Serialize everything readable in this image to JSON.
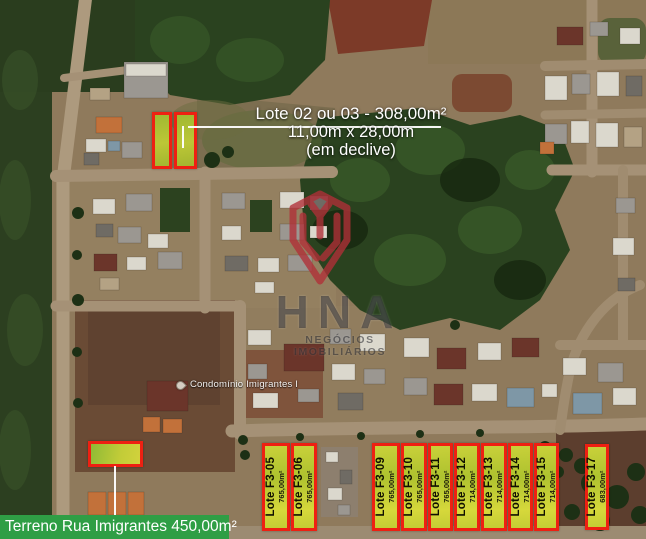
{
  "image": {
    "width": 646,
    "height": 539,
    "kind": "satellite-real-estate-listing"
  },
  "top_annotation": {
    "line1": "Lote 02 ou 03 - 308,00m²",
    "line2": "11,00m x 28,00m",
    "line3": "(em declive)"
  },
  "bottom_banner": {
    "text": "Terreno Rua Imigrantes 450,00m²"
  },
  "map_label": {
    "text": "Condomínio Imigrantes I"
  },
  "watermark": {
    "title": "HNA",
    "subtitle": "NEGÓCIOS IMOBILIÁRIOS"
  },
  "colors": {
    "lot_fill_yellow": "#c9d13a",
    "lot_border_red": "#ee2012",
    "banner_green": "#2f9e45",
    "annotation_text": "#ffffff",
    "watermark_red": "#b13038"
  },
  "top_lots": [
    {
      "id": "lote-02",
      "x": 152,
      "y": 112,
      "w": 20,
      "h": 57
    },
    {
      "id": "lote-03",
      "x": 174,
      "y": 112,
      "w": 23,
      "h": 57
    }
  ],
  "terreno_lot": {
    "id": "terreno-rua-imigrantes",
    "x": 88,
    "y": 441,
    "w": 55,
    "h": 26
  },
  "bottom_lots": [
    {
      "name": "Lote F3-05",
      "area": "765,00m²",
      "x": 262,
      "y": 443,
      "w": 28,
      "h": 88
    },
    {
      "name": "Lote F3-06",
      "area": "765,00m²",
      "x": 291,
      "y": 443,
      "w": 26,
      "h": 88
    },
    {
      "name": "Lote F3-09",
      "area": "765,00m²",
      "x": 372,
      "y": 443,
      "w": 28,
      "h": 88
    },
    {
      "name": "Lote F3-10",
      "area": "765,00m²",
      "x": 401,
      "y": 443,
      "w": 26,
      "h": 88
    },
    {
      "name": "Lote F3-11",
      "area": "765,00m²",
      "x": 428,
      "y": 443,
      "w": 25,
      "h": 88
    },
    {
      "name": "Lote F3-12",
      "area": "714,00m²",
      "x": 454,
      "y": 443,
      "w": 26,
      "h": 88
    },
    {
      "name": "Lote F3-13",
      "area": "714,00m²",
      "x": 481,
      "y": 443,
      "w": 26,
      "h": 88
    },
    {
      "name": "Lote F3-14",
      "area": "714,00m²",
      "x": 508,
      "y": 443,
      "w": 25,
      "h": 88
    },
    {
      "name": "Lote F3-15",
      "area": "714,00m²",
      "x": 534,
      "y": 443,
      "w": 25,
      "h": 88
    },
    {
      "name": "Lote F3-17",
      "area": "683,00m²",
      "x": 585,
      "y": 444,
      "w": 24,
      "h": 86
    }
  ]
}
